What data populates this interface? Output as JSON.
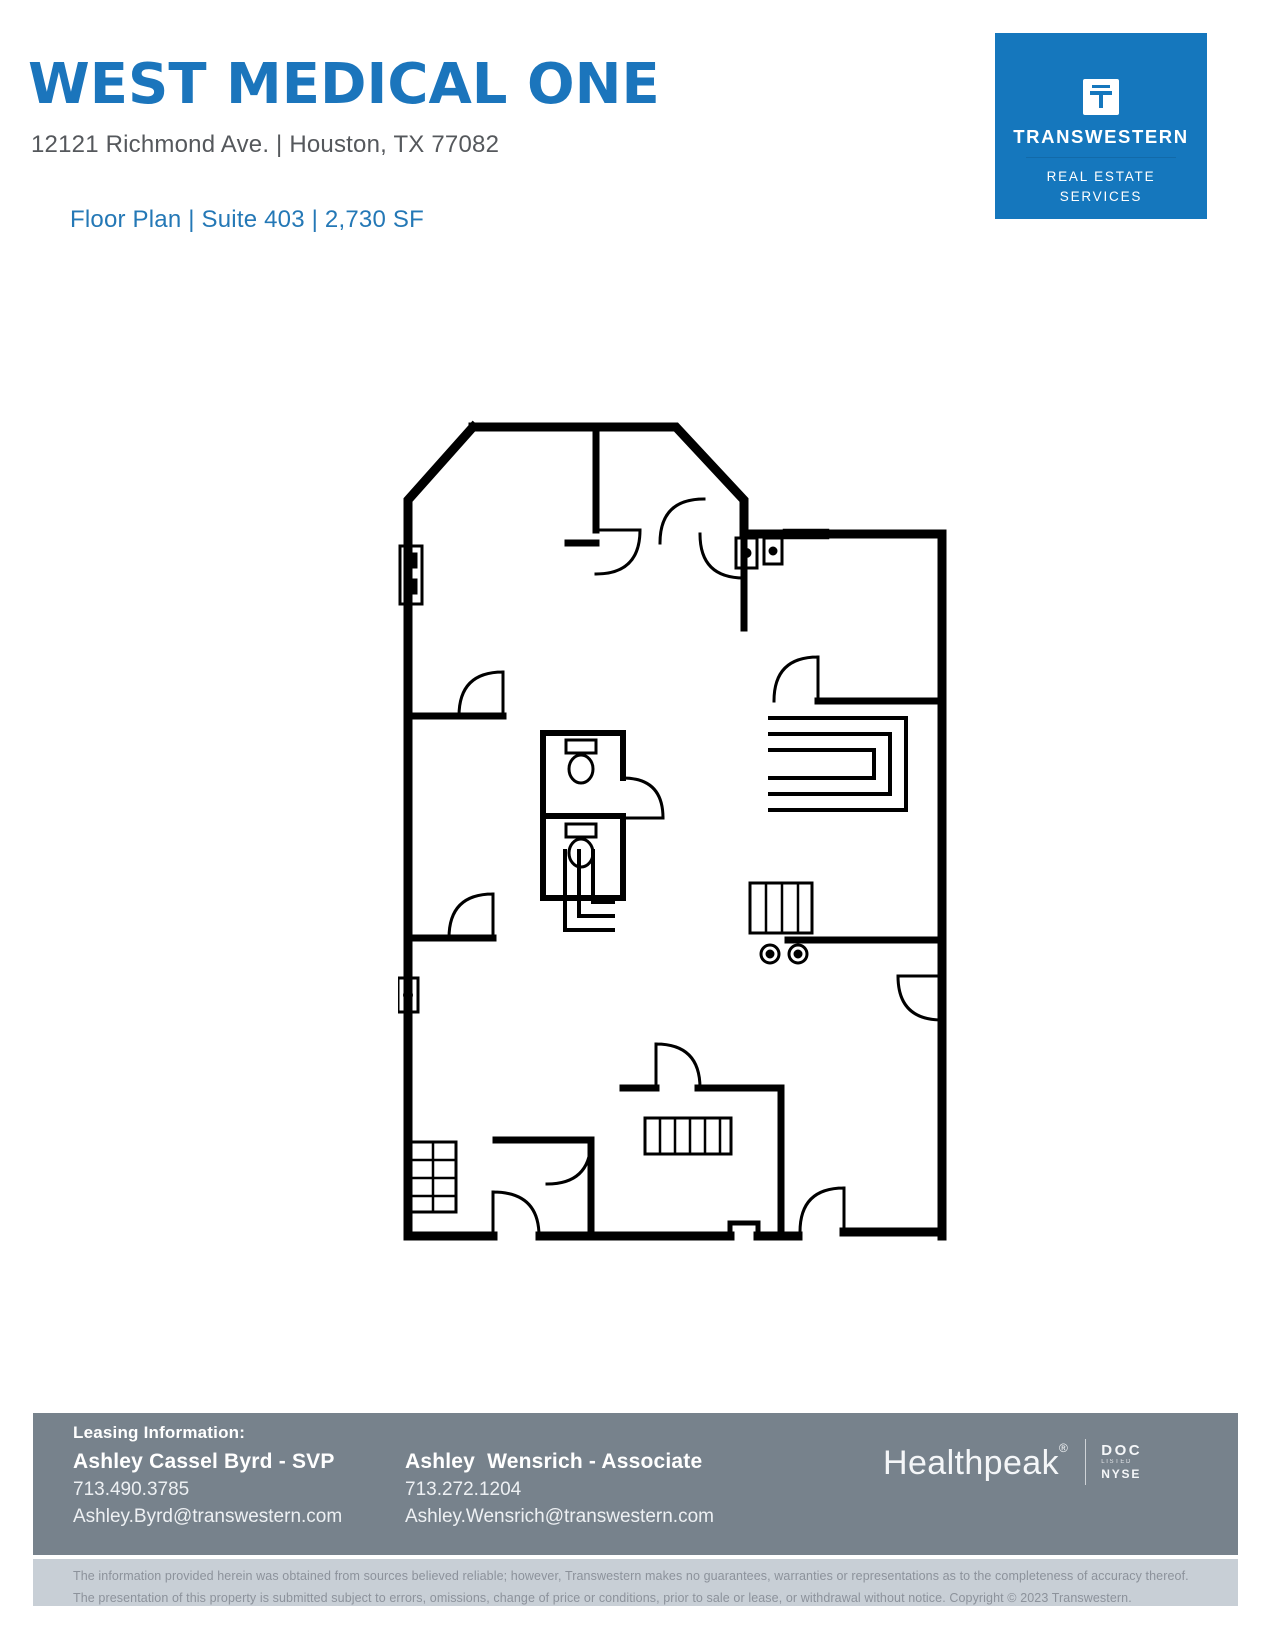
{
  "header": {
    "title": "WEST MEDICAL ONE",
    "address": "12121 Richmond Ave. | Houston, TX 77082",
    "subtitle": "Floor Plan | Suite 403 | 2,730 SF",
    "title_color": "#1B75BC",
    "subtitle_color": "#2478B6"
  },
  "logo": {
    "name": "TRANSWESTERN",
    "tagline_line1": "REAL ESTATE",
    "tagline_line2": "SERVICES",
    "bg_color": "#1577BD"
  },
  "footer": {
    "bar_color": "#77828C",
    "leasing_label": "Leasing Information:",
    "contacts": [
      {
        "name": "Ashley Cassel Byrd - SVP",
        "phone": "713.490.3785",
        "email": "Ashley.Byrd@transwestern.com"
      },
      {
        "name": "Ashley  Wensrich - Associate",
        "phone": "713.272.1204",
        "email": "Ashley.Wensrich@transwestern.com"
      }
    ],
    "healthpeak": {
      "name": "Healthpeak",
      "registered": "®",
      "ticker": "DOC",
      "listed": "LISTED",
      "exchange": "NYSE"
    }
  },
  "disclaimer": {
    "line1": "The information provided herein was obtained from sources believed reliable; however, Transwestern makes no guarantees, warranties or representations as to the completeness of accuracy thereof.",
    "line2": "The presentation of this property is submitted subject to errors, omissions, change of price or conditions, prior to sale or lease, or withdrawal without notice. Copyright © 2023 Transwestern."
  }
}
